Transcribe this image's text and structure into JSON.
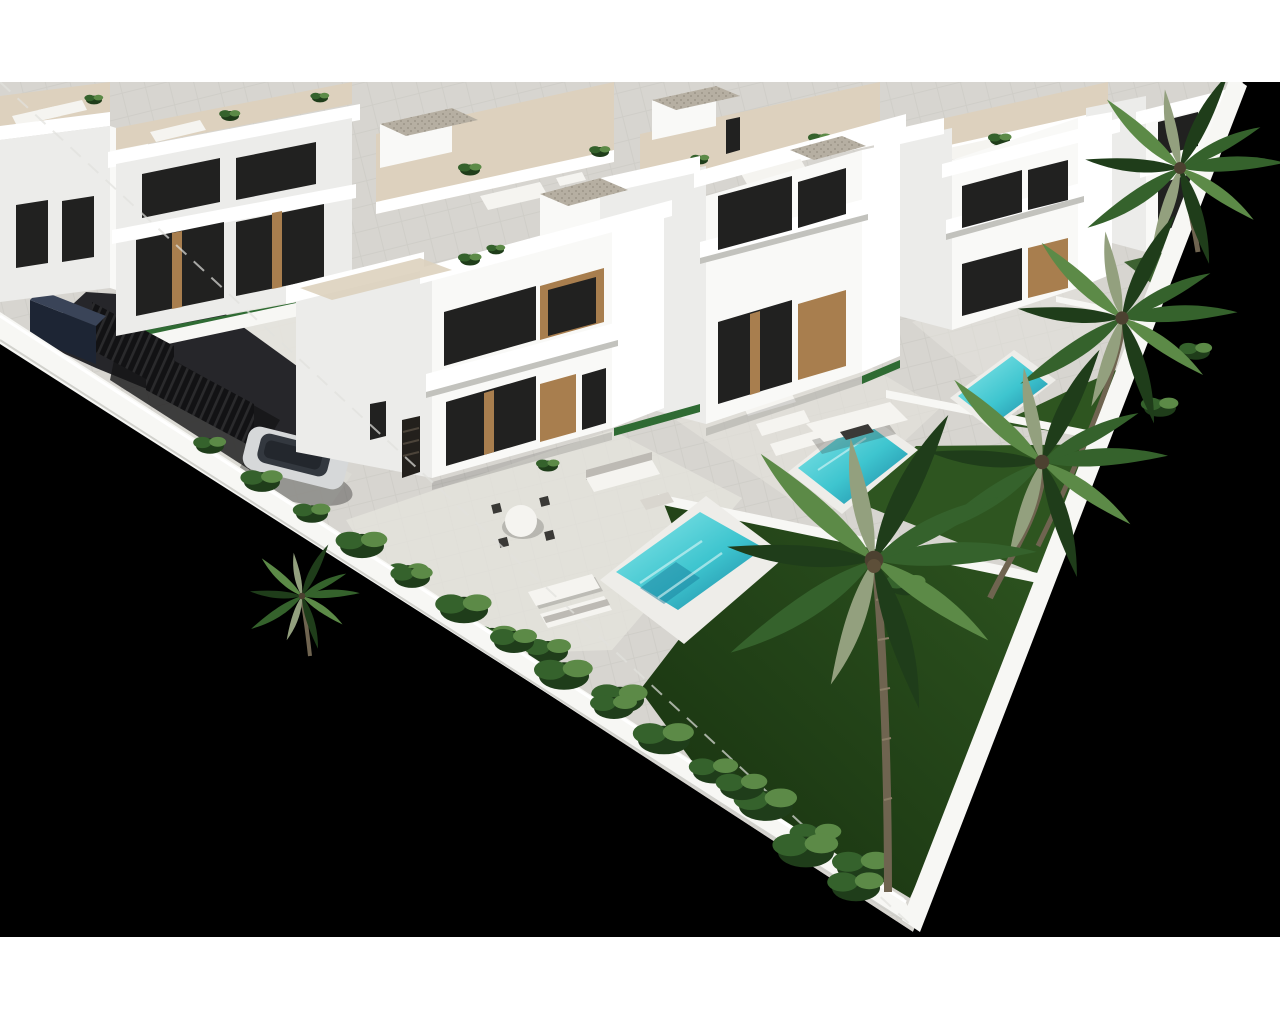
{
  "canvas": {
    "width": 1280,
    "height": 1024
  },
  "frame": {
    "top_white_band_height": 82,
    "bottom_white_band_start": 937,
    "backdrop_color": "#000000"
  },
  "palette": {
    "page_bg": "#ffffff",
    "backdrop": "#000000",
    "paving": "#d7d5d0",
    "paving_light": "#e6e4de",
    "patio": "#ded9d1",
    "wall_white": "#f7f7f4",
    "wall_shadow": "#c2c2bd",
    "villa_front": "#ececea",
    "villa_side": "#f9f9f7",
    "villa_bright": "#ffffff",
    "roof_floor": "#ddd1be",
    "gravel": "#b6afa2",
    "gravel_dot": "#958e81",
    "glass_dark": "#212120",
    "wood": "#a87e4e",
    "wood_dark": "#7c5a33",
    "pool_light": "#8ce8ea",
    "pool_mid": "#3ec5cf",
    "pool_deep": "#197f9e",
    "pool_teal": "#3bb2ab",
    "lawn_dark": "#17300f",
    "lawn_mid": "#2e5520",
    "lawn_light": "#477031",
    "palm_dark": "#1f3d1a",
    "palm_mid": "#35622c",
    "palm_light": "#5c8a47",
    "palm_dry": "#93a07e",
    "trunk": "#6f6450",
    "asphalt": "#26262a",
    "gate_black": "#121214",
    "car_silver": "#d6d8d9",
    "car_glass": "#33383f",
    "car_navy": "#1d2534",
    "furniture_white": "#f5f4f0",
    "furniture_shadow": "#bdbab4",
    "chair_dark": "#3a3936",
    "plant_green": "#2f6b33"
  },
  "scene": {
    "label": "aerial-3d-render-white-villa-development",
    "elements": [
      "white-villa",
      "rooftop-terrace",
      "roof-stair-box",
      "swimming-pool",
      "lap-pool",
      "pool-deck",
      "lawn",
      "garden-divider-wall",
      "perimeter-wall",
      "palm-tree",
      "tropical-shrub",
      "driveway",
      "entrance-gate",
      "garage-door",
      "suv-car",
      "dark-utility-box",
      "sun-lounger",
      "outdoor-dining-set",
      "outdoor-sofa",
      "canopy"
    ]
  }
}
